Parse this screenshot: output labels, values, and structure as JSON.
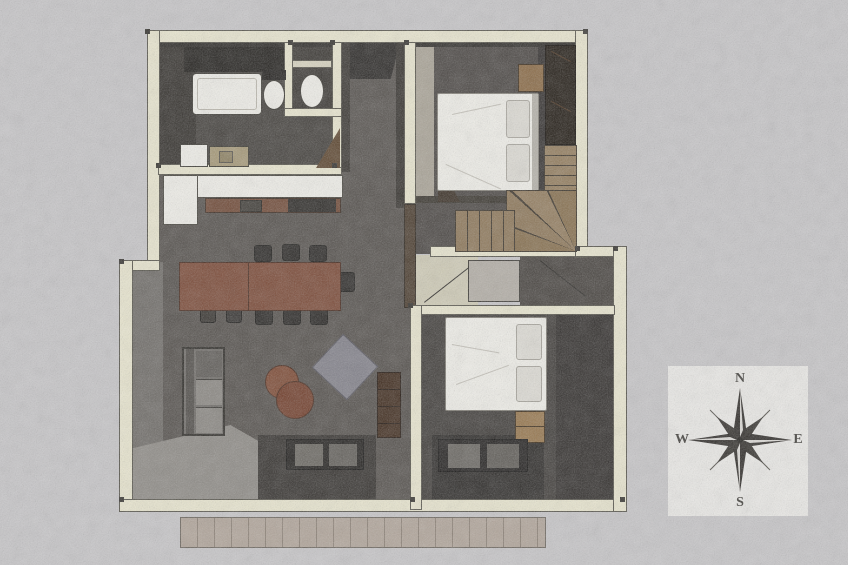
{
  "title": "house-floor-plan-sketch",
  "compass": {
    "north": "N",
    "east": "E",
    "south": "S",
    "west": "W"
  },
  "colors": {
    "background": "#c7c6c8",
    "wall": "#e9e6cf",
    "wall-outline": "#56544b",
    "floor": "#55514d",
    "floor-dark": "#3b3834",
    "fixture": "#f0efe9",
    "wood": "#8d7759",
    "table": "#7b4a37",
    "sofa": "#6e6b67",
    "rug": "#82818a",
    "deck": "#b1a59a",
    "compass-box": "#ebeae7",
    "ink": "#2f2c29"
  }
}
